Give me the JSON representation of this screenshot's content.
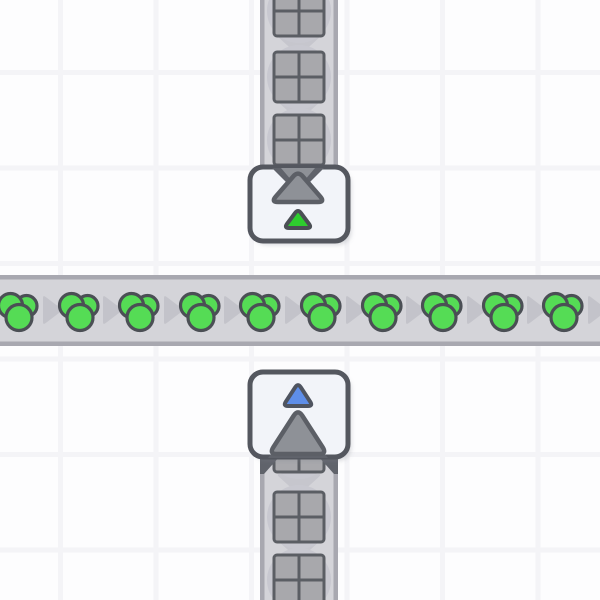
{
  "app": {
    "name": "factory-builder-game",
    "view": "world-grid",
    "visible_text": []
  },
  "colors": {
    "background": "#fdfdfe",
    "grid_line": "#f4f4f7",
    "belt": "#d4d4d9",
    "belt_edge": "#a8a8b0",
    "belt_arrow": "#c3c3ca",
    "belt_chevron": "#c6c6cd",
    "item_disc": "#c8c8d0",
    "square_fill": "#a8a8ac",
    "square_line": "#5b5e64",
    "circle_green": "#55dc55",
    "item_outline": "#4b4f55",
    "building_fill": "#f2f4f9",
    "building_border": "#54575f",
    "machine_gray": "#8e9197",
    "machine_gray_border": "#5c5f66",
    "funnel_dark": "#60636b",
    "triangle_green": "#2ecd2e",
    "triangle_blue": "#5e8ee9",
    "triangle_blue_border": "#4f5460",
    "shadow": "rgba(125,128,140,0.28)"
  },
  "scene": {
    "width": 600,
    "height": 600,
    "grid": {
      "v_lines": [
        60.5,
        156,
        251.5,
        347,
        442.5,
        538
      ],
      "h_lines": [
        72.5,
        168,
        263.5,
        359,
        454.5,
        550
      ],
      "line_width": 5
    },
    "belt_h": {
      "direction": "right",
      "top": 275,
      "bottom": 346,
      "x0": 0,
      "x1": 600,
      "edge": 4.5,
      "arrow_y": 310,
      "arrow_xs": [
        52,
        112,
        173,
        233,
        294,
        355,
        415,
        476,
        536,
        597
      ],
      "item_y": 311,
      "item_xs": [
        18,
        79,
        139,
        200,
        260,
        321,
        382,
        442,
        503,
        563
      ],
      "item_type": "green-resource-cluster",
      "cluster_circles": [
        {
          "dx": 8.5,
          "dy": -5,
          "r": 10.5
        },
        {
          "dx": -7.5,
          "dy": -5.5,
          "r": 12
        },
        {
          "dx": 1,
          "dy": 6.5,
          "r": 13
        }
      ]
    },
    "belt_v_top": {
      "direction": "down",
      "left": 260,
      "right": 338,
      "y0": 0,
      "y1": 170,
      "edge": 4.5,
      "cx": 299,
      "item_ys": [
        11,
        77,
        140
      ],
      "chevron_ys": [
        45,
        110
      ],
      "item_type": "gray-crate-window",
      "disc_r": 32,
      "square_size": 50
    },
    "belt_v_bottom": {
      "direction": "down",
      "left": 260,
      "right": 338,
      "y0": 450,
      "y1": 600,
      "edge": 4.5,
      "cx": 299,
      "item_ys": [
        447,
        517,
        580
      ],
      "chevron_ys": [
        484,
        549
      ],
      "item_type": "gray-crate-window",
      "disc_r": 32,
      "square_size": 50
    },
    "entrance": {
      "name": "underground-belt-entrance",
      "x": 250,
      "y": 167,
      "w": 98,
      "h": 74,
      "radius": 13,
      "intake_dark": [
        [
          272,
          168
        ],
        [
          324,
          168
        ],
        [
          298,
          194
        ]
      ],
      "intake_inner": [
        [
          281,
          168
        ],
        [
          315,
          168
        ],
        [
          298,
          188
        ]
      ],
      "big_triangle": [
        [
          298,
          171
        ],
        [
          271,
          202
        ],
        [
          325,
          202
        ]
      ],
      "small_triangle": {
        "points": [
          [
            298,
            209
          ],
          [
            284,
            228
          ],
          [
            312,
            228
          ]
        ],
        "color_key": "triangle_green",
        "border_key": "item_outline"
      }
    },
    "exit": {
      "name": "underground-belt-exit",
      "x": 250,
      "y": 372,
      "w": 98,
      "h": 85,
      "radius": 13,
      "wings": [
        [
          [
            260,
            456
          ],
          [
            280,
            456
          ],
          [
            264,
            474
          ],
          [
            260,
            474
          ]
        ],
        [
          [
            338,
            456
          ],
          [
            318,
            456
          ],
          [
            334,
            474
          ],
          [
            338,
            474
          ]
        ]
      ],
      "skirt": [
        [
          280,
          443
        ],
        [
          316,
          443
        ],
        [
          328,
          458
        ],
        [
          268,
          458
        ]
      ],
      "big_triangle": [
        [
          298,
          409
        ],
        [
          269,
          454
        ],
        [
          327,
          454
        ]
      ],
      "small_triangle": {
        "points": [
          [
            298,
            383
          ],
          [
            283,
            406
          ],
          [
            313,
            406
          ]
        ],
        "color_key": "triangle_blue",
        "border_key": "triangle_blue_border"
      }
    }
  }
}
